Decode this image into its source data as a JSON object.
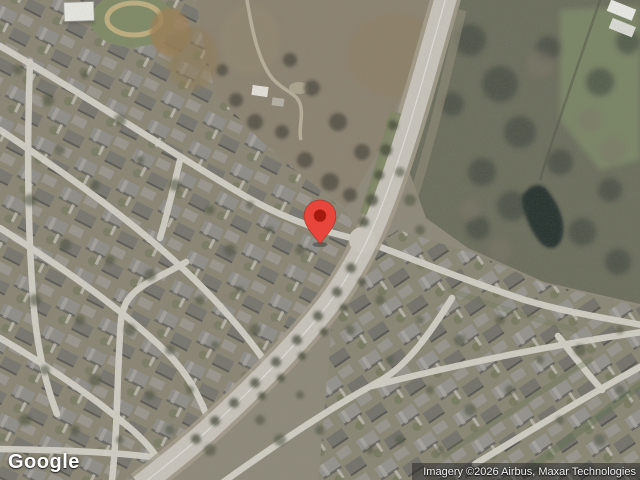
{
  "map": {
    "view_type": "satellite",
    "marker": {
      "name": "location-pin",
      "tip_x": 320,
      "tip_y": 245,
      "fill": "#E8463C",
      "dot": "#A81A0F"
    }
  },
  "footer": {
    "logo": "Google",
    "attribution": "Imagery ©2026 Airbus, Maxar Technologies"
  }
}
